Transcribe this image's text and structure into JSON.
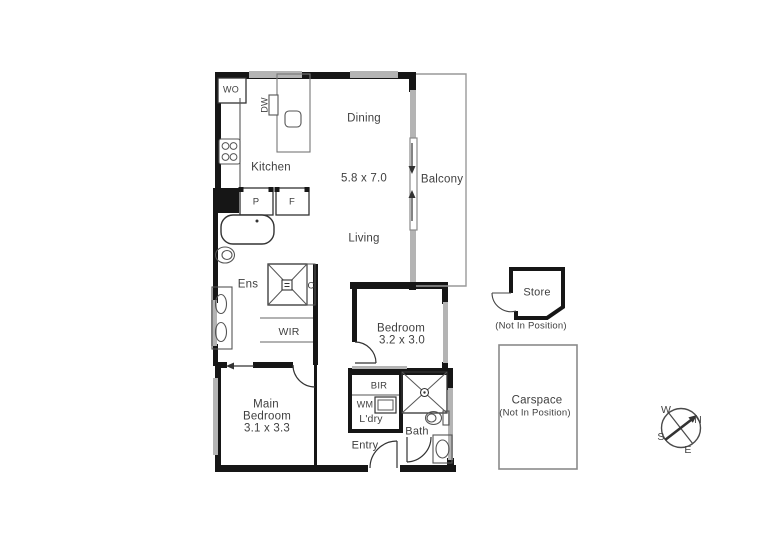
{
  "plan": {
    "labels": {
      "wo": "WO",
      "dw": "DW",
      "kitchen": "Kitchen",
      "dining": "Dining",
      "living": "Living",
      "living_dims": "5.8 x 7.0",
      "balcony": "Balcony",
      "p": "P",
      "f": "F",
      "ens": "Ens",
      "c": "C",
      "wir": "WIR",
      "bedroom": "Bedroom",
      "bedroom_dims": "3.2 x 3.0",
      "main1": "Main",
      "main2": "Bedroom",
      "main_dims": "3.1 x 3.3",
      "bir": "BIR",
      "wm": "WM",
      "ldry": "L'dry",
      "bath": "Bath",
      "entry": "Entry"
    },
    "outbuildings": {
      "store": "Store",
      "store_note": "(Not In Position)",
      "carspace": "Carspace",
      "carspace_note": "(Not In Position)"
    },
    "compass": {
      "n": "N",
      "w": "W",
      "s": "S",
      "e": "E"
    },
    "colors": {
      "wall": "#161616",
      "window": "#b4b4b4",
      "fixture_line": "#555555",
      "text": "#3f3f3f"
    }
  }
}
